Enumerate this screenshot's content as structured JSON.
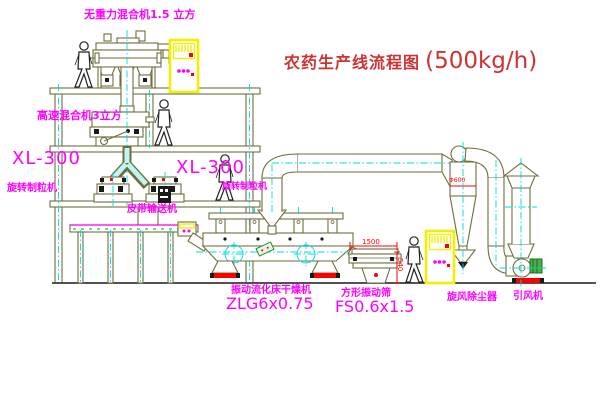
{
  "title": {
    "text": "农药生产线流程图",
    "capacity": "(500kg/h)"
  },
  "labels": {
    "mixer_top": "无重力混合机1.5 立方",
    "mixer_mid": "高速混合机3立方",
    "granulator_left_model": "XL-300",
    "granulator_left_name": "旋转制粒机",
    "granulator_right_model": "XL-300",
    "granulator_right_name": "旋转制粒机",
    "belt_conveyor": "皮带输送机",
    "dryer_name": "振动流化床干燥机",
    "dryer_model": "ZLG6x0.75",
    "sieve_name": "方形振动筛",
    "sieve_model": "FS0.6x1.5",
    "cyclone": "旋风除尘器",
    "fan": "引风机"
  },
  "dimensions": {
    "sieve_width": "1500",
    "sieve_height": "540",
    "cyclone_dia": "Φ600"
  },
  "colors": {
    "label_magenta": "#ff00ff",
    "title_red": "#cc3434",
    "machine_olive": "#6e6e3c",
    "centerline_cyan": "#00dcdc",
    "cabinet_yellow": "#f0f000",
    "accent_red": "#ff0000",
    "motor_green": "#49b049"
  }
}
